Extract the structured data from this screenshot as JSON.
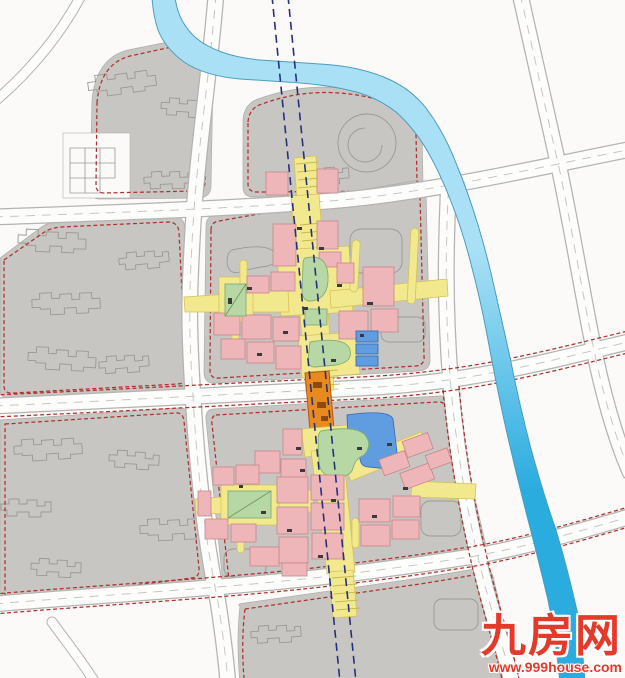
{
  "map": {
    "type": "urban-master-plan",
    "features": {
      "river": "river",
      "metro": "two dashed transit alignment lines",
      "upper_cluster": "mixed-use center north block",
      "lower_cluster": "mixed-use center south block",
      "station_bridge": "orange elevated link over middle road"
    }
  },
  "palette": {
    "background": "#fbfaf8",
    "parcel_gray": "#c8c6c3",
    "road_fill": "#fdfdfc",
    "road_edge": "#b5b3b0",
    "boundary_red": "#ab332f",
    "river_light": "#a9e0f5",
    "river_deep": "#2bacdf",
    "pedestrian_yellow": "#f2e98f",
    "building_pink": "#efb6ba",
    "green_space": "#b7d8a4",
    "building_blue": "#5f9de0",
    "station_orange": "#e98a1e",
    "metro_line": "#27307f",
    "footprint_line": "#9b9995",
    "entrance_dark": "#3a3a38",
    "watermark_red": "#e43a2a"
  },
  "watermark": {
    "brand": "九房网",
    "url": "www.999house.com"
  }
}
